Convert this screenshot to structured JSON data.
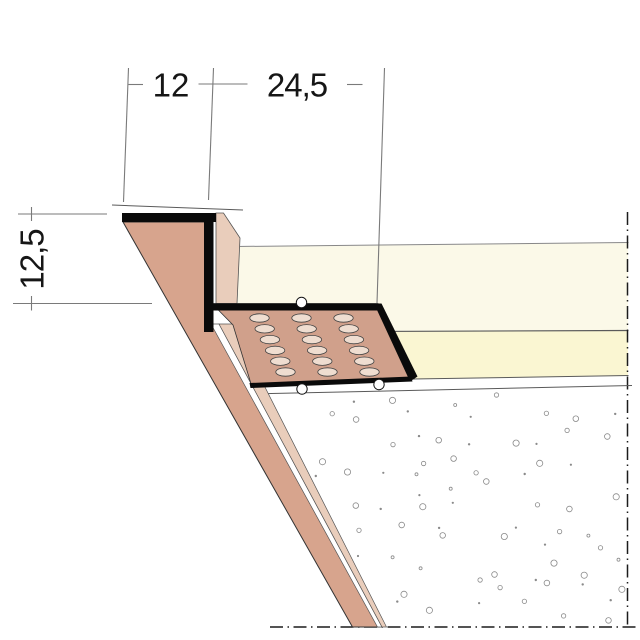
{
  "dimensions": {
    "top_flange_width": "12",
    "perforated_flange_width": "24,5",
    "leg_height": "12,5"
  },
  "colors": {
    "bg": "#ffffff",
    "profile": "#0a0a0a",
    "board_edge": "#d7a48d",
    "flange_plate": "#d0a08b",
    "hole": "#efddd0",
    "strip_pale": "#e9cdbb",
    "strip_white": "#ffffff",
    "cream_upper": "#fbf9e8",
    "cream_lower": "#faf6d2",
    "line": "#5a5a5a",
    "line_light": "#888888",
    "centerline": "#1c1c1c",
    "dim": "#7a7a7a",
    "text": "#161616",
    "stipple": "#8a8a8a"
  },
  "drawing": {
    "holes": {
      "x0": 259.5,
      "y0": 318,
      "cols": 3,
      "rows": 6,
      "col_dx": 42,
      "row_dx": 5.2,
      "row_dy": 10.8,
      "rx": 9.7,
      "ry": 4.2
    },
    "stipple": {
      "x_start": 256,
      "x_end": 633,
      "x_step": 36,
      "y_start": 398,
      "y_end": 622,
      "y_step": 16,
      "density": 0.58,
      "radii": [
        1.1,
        1.5,
        2.2,
        2.8,
        1.2,
        3.1
      ]
    },
    "centerline_dash": "13 4.5 1.5 4.5"
  }
}
